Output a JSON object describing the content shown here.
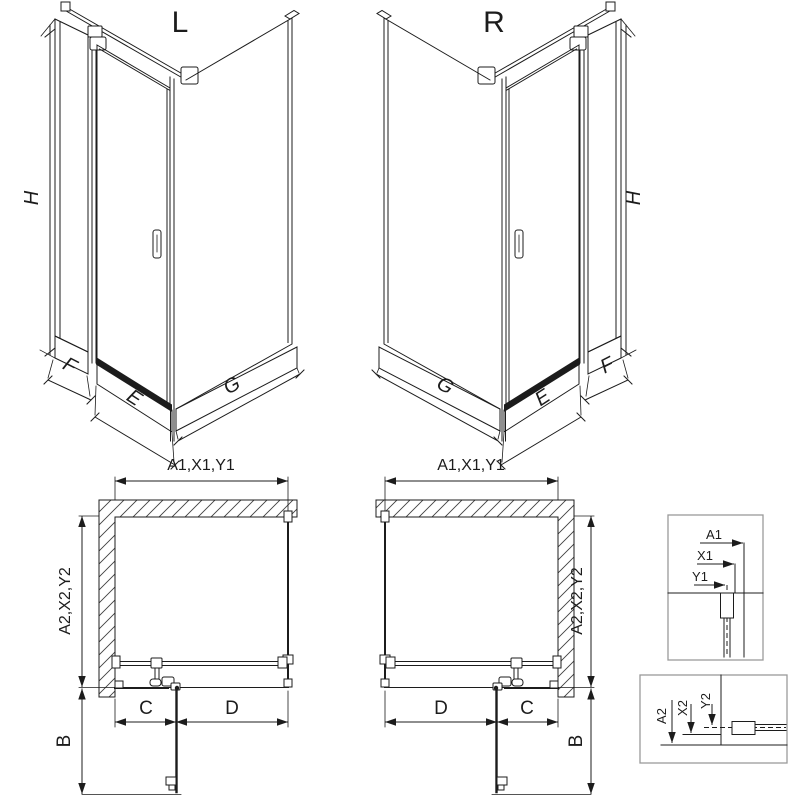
{
  "colors": {
    "line": "#1c1c1c",
    "detail_border": "#9a9a9a",
    "hatch": "#404040",
    "background": "#ffffff"
  },
  "iso_left": {
    "title": "L",
    "dim_h": "H",
    "dim_f": "F",
    "dim_e": "E",
    "dim_g": "G"
  },
  "iso_right": {
    "title": "R",
    "dim_h": "H",
    "dim_f": "F",
    "dim_e": "E",
    "dim_g": "G"
  },
  "plan_left": {
    "dim_width": "A1,X1,Y1",
    "dim_depth": "A2,X2,Y2",
    "dim_c": "C",
    "dim_d": "D",
    "dim_b": "B"
  },
  "plan_right": {
    "dim_width": "A1,X1,Y1",
    "dim_depth": "A2,X2,Y2",
    "dim_c": "C",
    "dim_d": "D",
    "dim_b": "B"
  },
  "detail_top": {
    "dim_a1": "A1",
    "dim_x1": "X1",
    "dim_y1": "Y1"
  },
  "detail_bottom": {
    "dim_a2": "A2",
    "dim_x2": "X2",
    "dim_y2": "Y2"
  }
}
